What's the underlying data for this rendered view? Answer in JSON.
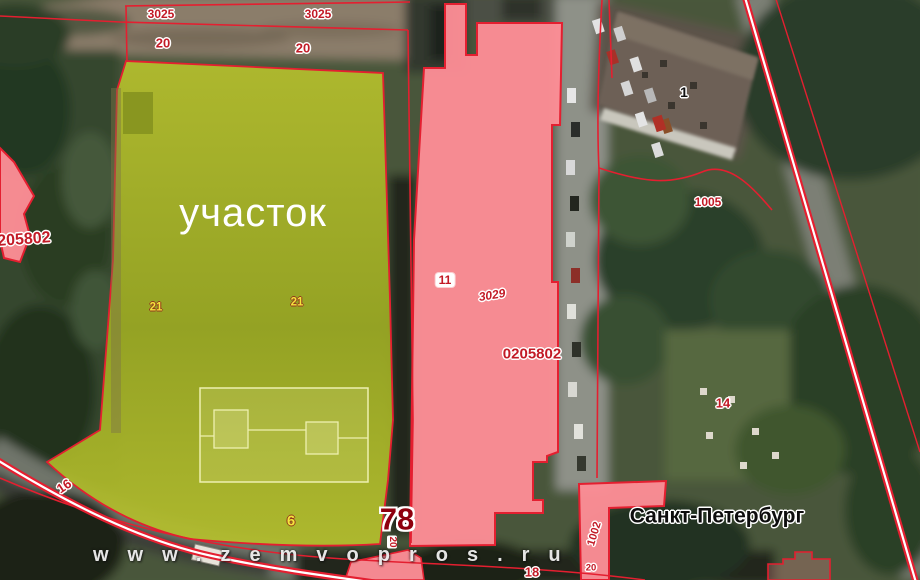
{
  "map": {
    "plot_label": "участок",
    "city_label": "Санкт-Петербург",
    "watermark": "www.zemvopros.ru",
    "cadastral_labels": {
      "quarter_3025": "3025",
      "parcel_20": "20",
      "parcel_21": "21",
      "parcel_11": "11",
      "quarter_3029": "3029",
      "masked_0205802": "0205802",
      "masked_205802": "205802",
      "parcel_78": "78",
      "parcel_6": "6",
      "parcel_16": "16",
      "parcel_14": "14",
      "parcel_18": "18",
      "parcel_1005": "1005",
      "parcel_1002": "1002",
      "building_1": "1",
      "small_20": "20"
    },
    "colors": {
      "plot_highlight_fill": "#b5bf2d",
      "plot_highlight_dark": "#9aa822",
      "parcel_fill": "#fd8e96",
      "boundary_line": "#e41f30",
      "cadastral_label_red": "#c21a26",
      "cadastral_label_yellow": "#f4e43c"
    }
  }
}
